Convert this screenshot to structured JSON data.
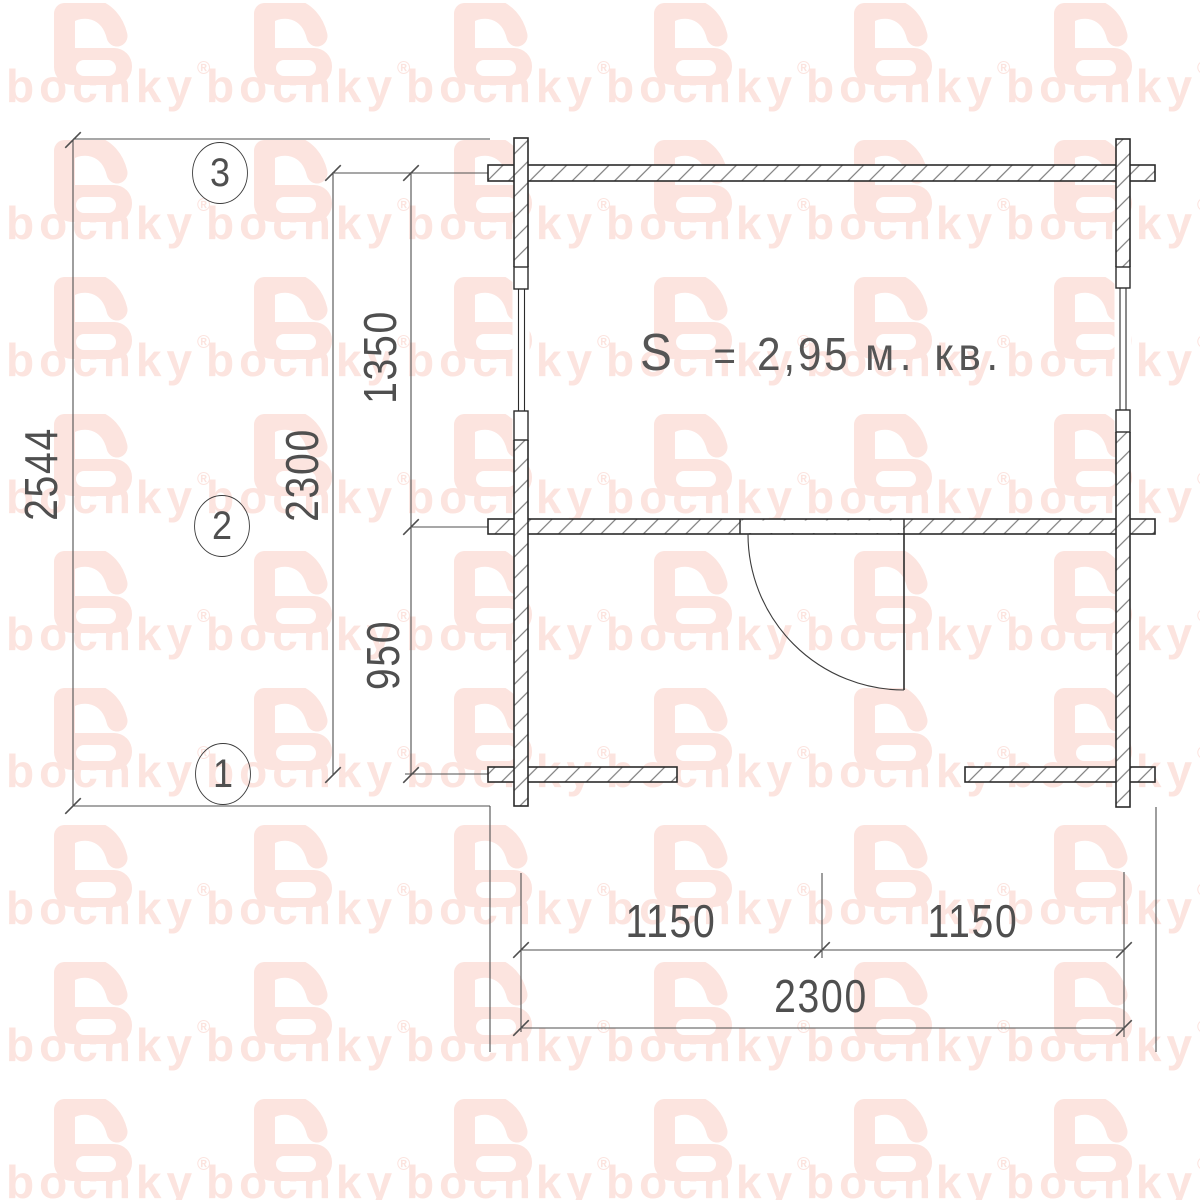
{
  "watermark": {
    "word": "bochky",
    "reg": "®"
  },
  "axes": [
    {
      "id": "3"
    },
    {
      "id": "2"
    },
    {
      "id": "1"
    }
  ],
  "dimensions": {
    "left_overall": "2544",
    "left_total": "2300",
    "left_top_segment": "1350",
    "left_bottom_segment": "950",
    "bottom_left_half": "1150",
    "bottom_right_half": "1150",
    "bottom_total": "2300"
  },
  "area_label": {
    "s": "S",
    "eq": "=",
    "value": "2,95",
    "unit": "м. кв."
  },
  "colors": {
    "watermark_pink": "#fce4df",
    "wall_line": "#2b2b2b",
    "dim_line": "#4f4f4f",
    "hatch": "#7d7d7d"
  }
}
